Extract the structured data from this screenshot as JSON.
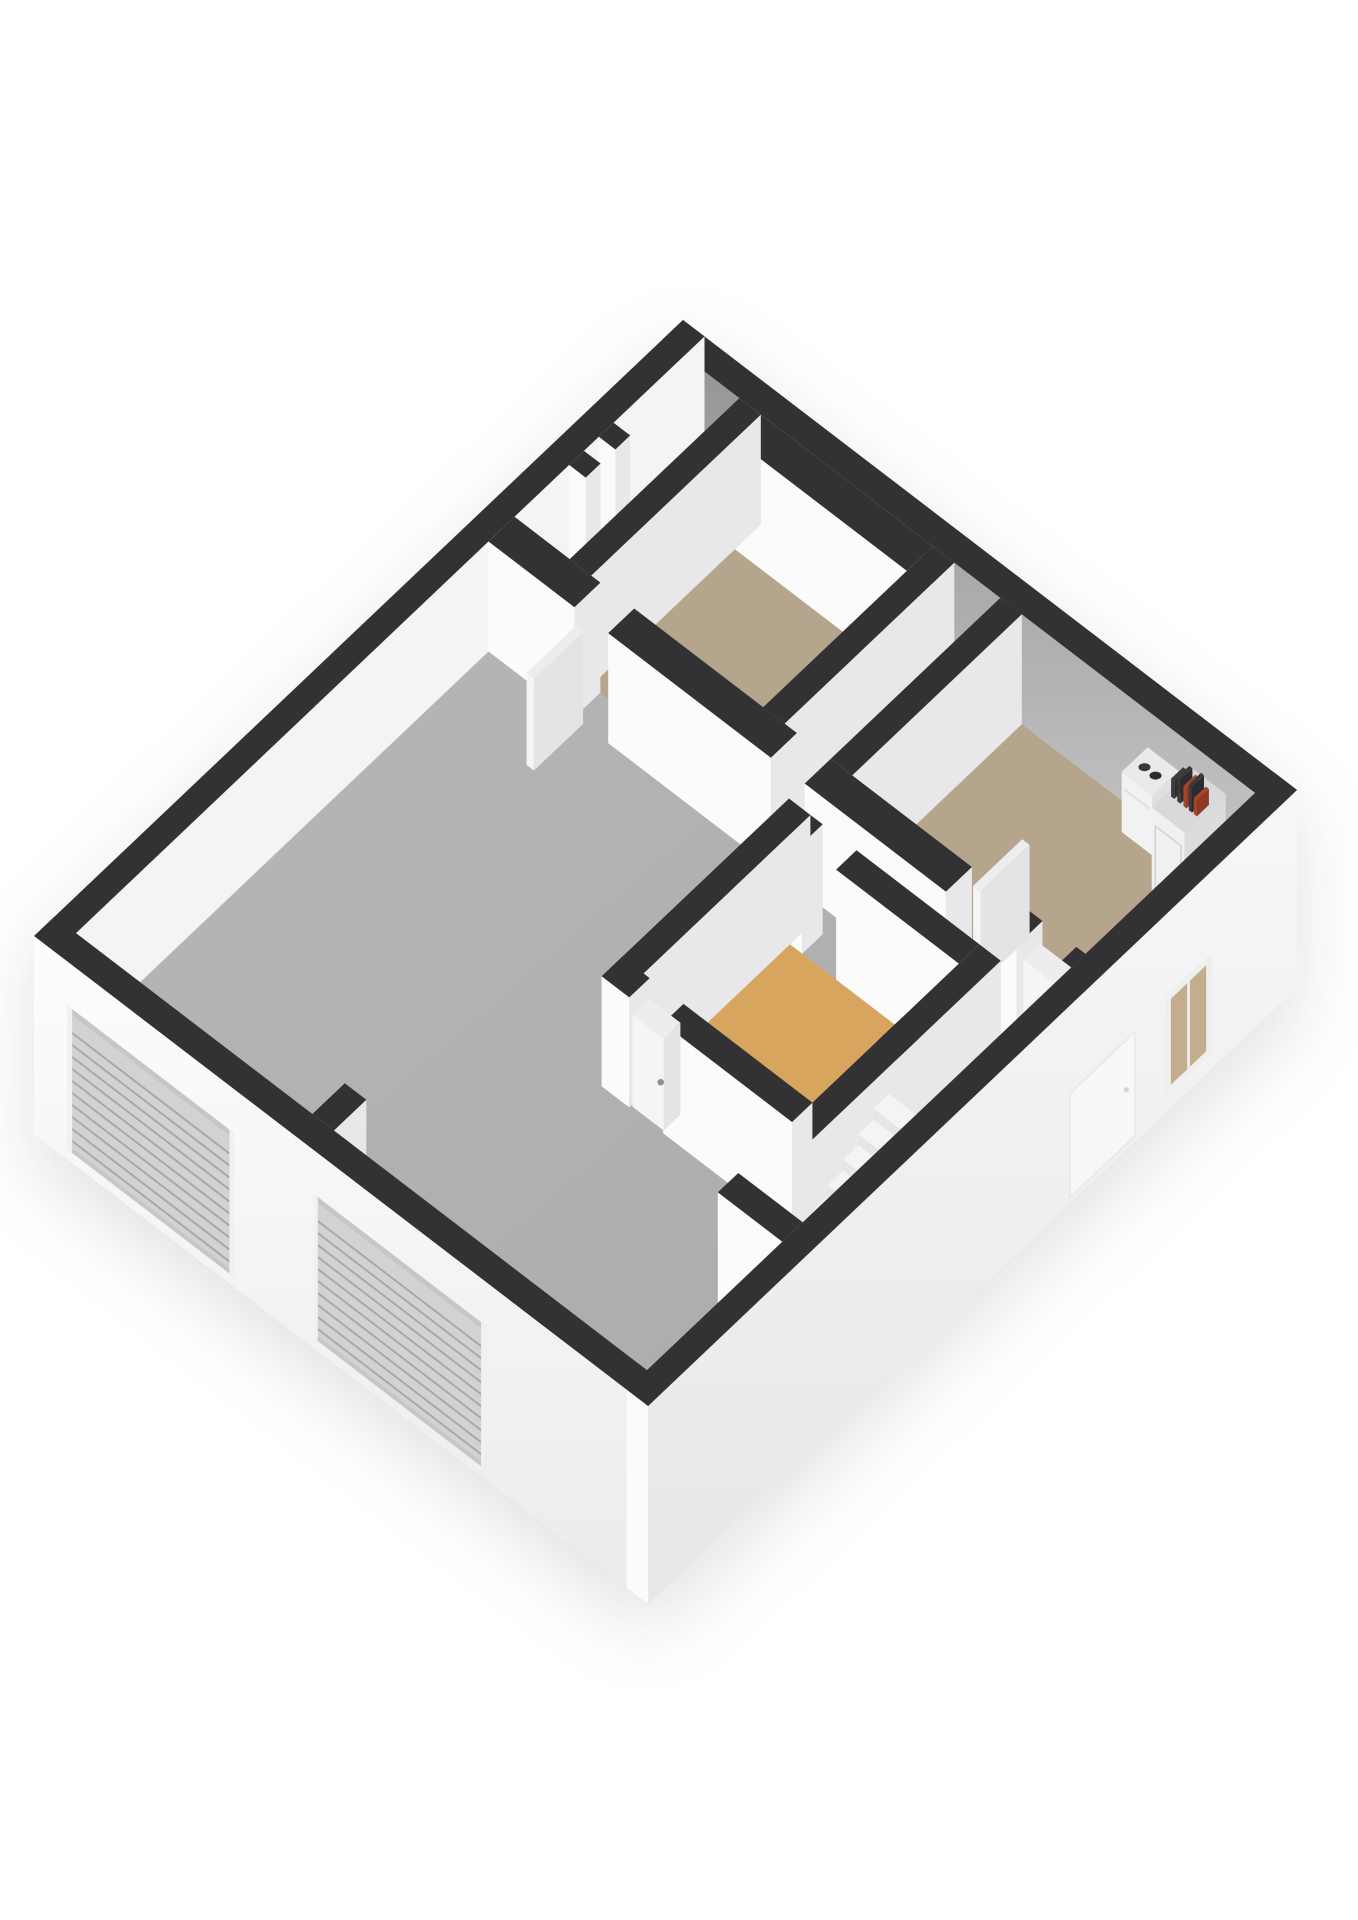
{
  "page": {
    "background": "#ffffff",
    "width": 1358,
    "height": 1920
  },
  "floorplan": {
    "kind": "isometric-3d-floorplan",
    "camera": {
      "x0": 683,
      "y0": 430,
      "axisA": [
        61.4,
        47.0
      ],
      "axisB": [
        -92.7,
        88.0
      ],
      "wallTop": 110,
      "plinth": 88
    },
    "colors": {
      "cap": "#323234",
      "faceS": "#fbfbfc",
      "faceE": "#e8e8ea",
      "nwInner": "#f4f4f6",
      "gradNE": "url(#gradNE)",
      "gradFloor": "url(#gradFloor)",
      "gradSW": "url(#gradSW)",
      "gradSE": "url(#gradSE)",
      "floorTan": "#b5a58c",
      "floorOrange": "#d7a55e",
      "leaf": "#f5f5f6",
      "leafSide": "#e4e4e6",
      "leafTop": "#ededef",
      "handle": "#8f8f91",
      "garageRecess": "#c6c6c8",
      "garagePanel": "#d2d2d4",
      "garageSlat": "#a7a7a9",
      "garageJamb": "#f1f1f3",
      "windowFrame": "#efeff0",
      "windowGlass": "#c3ad8c",
      "boilerS": "#f2f2f3",
      "boilerE": "#e0e0e2",
      "boilerTop": "#eaeaec",
      "boilerPort1": "#3b3733",
      "boilerPort2": "#2e2b28",
      "cabinetS": "#eff0f1",
      "cabinetE": "#dcdcde",
      "cabinetTop": "#d9d9db",
      "cabinetLine": "#d0d0d2",
      "pipeDark": "#3a3a3c",
      "pipeDarkSide": "#2c2c2e",
      "pipeRed": "#a8432c",
      "pipeRedSide": "#8f3824",
      "stepTop": "#f4f4f5",
      "stepS": "#e6e6e8",
      "stepE": "#d8d8da",
      "faintDoor": "#f7f7f8",
      "faintDoorEdge": "#e8e8e9",
      "faintHandle": "#d4d4d6"
    },
    "scene": [
      {
        "t": "wall",
        "n": "outer-wall-ne",
        "r": [
          0,
          0,
          10,
          0.22
        ],
        "z": [
          0,
          110
        ],
        "s": "gradNE"
      },
      {
        "t": "wall",
        "n": "outer-wall-nw",
        "r": [
          0,
          0,
          0.35,
          7
        ],
        "z": [
          -88,
          110
        ],
        "e": "nwInner"
      },
      {
        "t": "floor",
        "n": "floor-main-room",
        "r": [
          0.35,
          0.22,
          9.65,
          6.78
        ],
        "f": "gradFloor"
      },
      {
        "t": "floor",
        "n": "floor-bedroom-top",
        "r": [
          1.6,
          0.5,
          4.4,
          2.05
        ],
        "f": "floorTan"
      },
      {
        "t": "floor",
        "n": "floor-bedroom-east",
        "r": [
          5.85,
          0.22,
          9.65,
          2.05
        ],
        "f": "floorTan"
      },
      {
        "t": "floor",
        "n": "floor-bedroom-middle",
        "r": [
          5.85,
          2.72,
          8.6,
          4.3
        ],
        "f": "floorOrange"
      },
      {
        "t": "wall",
        "n": "duct-stub-1",
        "r": [
          0.35,
          0.98,
          0.62,
          1.14
        ],
        "z": [
          0,
          110
        ]
      },
      {
        "t": "wall",
        "n": "duct-stub-2",
        "r": [
          0.35,
          1.3,
          0.62,
          1.46
        ],
        "z": [
          0,
          110
        ]
      },
      {
        "t": "wall",
        "n": "bedroom-top-wall-n",
        "r": [
          1.6,
          0.22,
          4.4,
          0.5
        ],
        "z": [
          0,
          110
        ]
      },
      {
        "t": "wall",
        "n": "bedroom-top-wall-w",
        "r": [
          1.25,
          0.22,
          1.6,
          2.05
        ],
        "z": [
          0,
          110
        ]
      },
      {
        "t": "wall",
        "n": "bedroom-top-wall-e",
        "r": [
          4.4,
          0.22,
          4.75,
          2.05
        ],
        "z": [
          0,
          110
        ]
      },
      {
        "t": "wall",
        "n": "bedroom-east-wall-w",
        "r": [
          5.5,
          0.22,
          5.85,
          2.05
        ],
        "z": [
          0,
          110
        ]
      },
      {
        "t": "boiler",
        "n": "boiler-unit",
        "r": [
          8.02,
          0.3,
          8.52,
          0.58
        ],
        "z": [
          26,
          86
        ]
      },
      {
        "t": "cabinet",
        "n": "utility-cabinet",
        "r": [
          8.72,
          0.28,
          9.26,
          0.72
        ],
        "z": [
          0,
          96
        ],
        "pipes": [
          {
            "x": 8.82,
            "h": 18
          },
          {
            "x": 8.92,
            "h": 24
          },
          {
            "x": 9.02,
            "h": 20,
            "red": true
          },
          {
            "x": 9.11,
            "h": 26
          },
          {
            "x": 9.19,
            "h": 16,
            "red": true
          }
        ]
      },
      {
        "t": "wall",
        "n": "long-wall-seg-1",
        "r": [
          0.35,
          2.05,
          1.75,
          2.33
        ],
        "z": [
          0,
          110
        ]
      },
      {
        "t": "wall",
        "n": "long-wall-seg-2",
        "r": [
          2.3,
          2.05,
          4.95,
          2.33
        ],
        "z": [
          0,
          110
        ]
      },
      {
        "t": "wall",
        "n": "long-wall-seg-3",
        "r": [
          5.5,
          2.05,
          7.8,
          2.33
        ],
        "z": [
          0,
          110
        ]
      },
      {
        "t": "wall",
        "n": "long-wall-seg-4",
        "r": [
          8.35,
          2.05,
          8.95,
          2.33
        ],
        "z": [
          0,
          110
        ]
      },
      {
        "t": "wall",
        "n": "long-wall-seg-5",
        "r": [
          9.5,
          2.05,
          9.65,
          2.33
        ],
        "z": [
          0,
          110
        ]
      },
      {
        "t": "leaf",
        "n": "door-top-bedroom",
        "r": [
          1.77,
          2.33,
          1.89,
          2.86
        ],
        "z": [
          0,
          92
        ]
      },
      {
        "t": "leaf",
        "n": "door-east-bedroom-open",
        "r": [
          7.82,
          1.52,
          7.94,
          2.05
        ],
        "z": [
          0,
          92
        ]
      },
      {
        "t": "leaf",
        "n": "door-hall",
        "r": [
          8.97,
          2.09,
          9.48,
          2.27
        ],
        "z": [
          0,
          92
        ],
        "handle": [
          9.43,
          2.27,
          46
        ]
      },
      {
        "t": "wall",
        "n": "bedroom-middle-wall-n-seg-1",
        "r": [
          5.85,
          2.5,
          6.05,
          2.72
        ],
        "z": [
          0,
          110
        ]
      },
      {
        "t": "wall",
        "n": "bedroom-middle-wall-n-seg-2",
        "r": [
          6.6,
          2.5,
          8.6,
          2.72
        ],
        "z": [
          0,
          110
        ]
      },
      {
        "t": "wall",
        "n": "stair-wall-n-seg-1",
        "r": [
          8.6,
          3.38,
          8.98,
          3.6
        ],
        "z": [
          0,
          110
        ]
      },
      {
        "t": "wall",
        "n": "stair-wall-n-seg-2",
        "r": [
          9.52,
          3.38,
          9.65,
          3.6
        ],
        "z": [
          0,
          110
        ]
      },
      {
        "t": "wall",
        "n": "bedroom-middle-wall-w",
        "r": [
          5.5,
          2.5,
          5.85,
          4.52
        ],
        "z": [
          0,
          110
        ]
      },
      {
        "t": "wall",
        "n": "bedroom-middle-wall-e",
        "r": [
          8.6,
          2.5,
          8.95,
          5.32
        ],
        "z": [
          0,
          110
        ]
      },
      {
        "t": "stairs",
        "n": "staircase",
        "x": [
          9.0,
          9.62
        ],
        "yStart": 5.06,
        "depth": 0.165,
        "count": 8,
        "rise": 11
      },
      {
        "t": "wall",
        "n": "bedroom-middle-wall-s-seg-1",
        "r": [
          5.5,
          4.3,
          5.95,
          4.52
        ],
        "z": [
          0,
          110
        ]
      },
      {
        "t": "wall",
        "n": "bedroom-middle-wall-s-seg-2",
        "r": [
          6.5,
          4.3,
          8.6,
          4.52
        ],
        "z": [
          0,
          110
        ]
      },
      {
        "t": "leaf",
        "n": "door-middle-bedroom",
        "r": [
          5.97,
          4.32,
          6.48,
          4.5
        ],
        "z": [
          0,
          92
        ],
        "handle": [
          6.43,
          4.5,
          46
        ]
      },
      {
        "t": "wall",
        "n": "stair-wall-s",
        "r": [
          8.6,
          5.1,
          9.65,
          5.32
        ],
        "z": [
          0,
          110
        ]
      },
      {
        "t": "wall",
        "n": "garage-divider-stub",
        "r": [
          4.2,
          6.43,
          4.55,
          6.78
        ],
        "z": [
          0,
          110
        ]
      },
      {
        "t": "wall",
        "n": "outer-wall-sw",
        "r": [
          0,
          6.78,
          10,
          7
        ],
        "z": [
          -88,
          110
        ],
        "s": "gradSW"
      },
      {
        "t": "garage",
        "n": "garage-door-1",
        "x": [
          0.55,
          3.25
        ],
        "z": [
          -78,
          66
        ],
        "slats": 10
      },
      {
        "t": "garage",
        "n": "garage-door-2",
        "x": [
          4.55,
          7.35
        ],
        "z": [
          -78,
          66
        ],
        "slats": 10
      },
      {
        "t": "wall",
        "n": "outer-wall-se",
        "r": [
          9.65,
          0,
          10,
          7
        ],
        "z": [
          -88,
          110
        ],
        "e": "gradSE"
      },
      {
        "t": "window",
        "n": "window-se",
        "y": [
          0.92,
          1.42
        ],
        "z": [
          -72,
          28
        ]
      },
      {
        "t": "door-faint",
        "n": "entry-door-se",
        "y": [
          1.75,
          2.45
        ],
        "z": [
          -82,
          22
        ],
        "handle": [
          1.84,
          -28
        ]
      }
    ]
  }
}
